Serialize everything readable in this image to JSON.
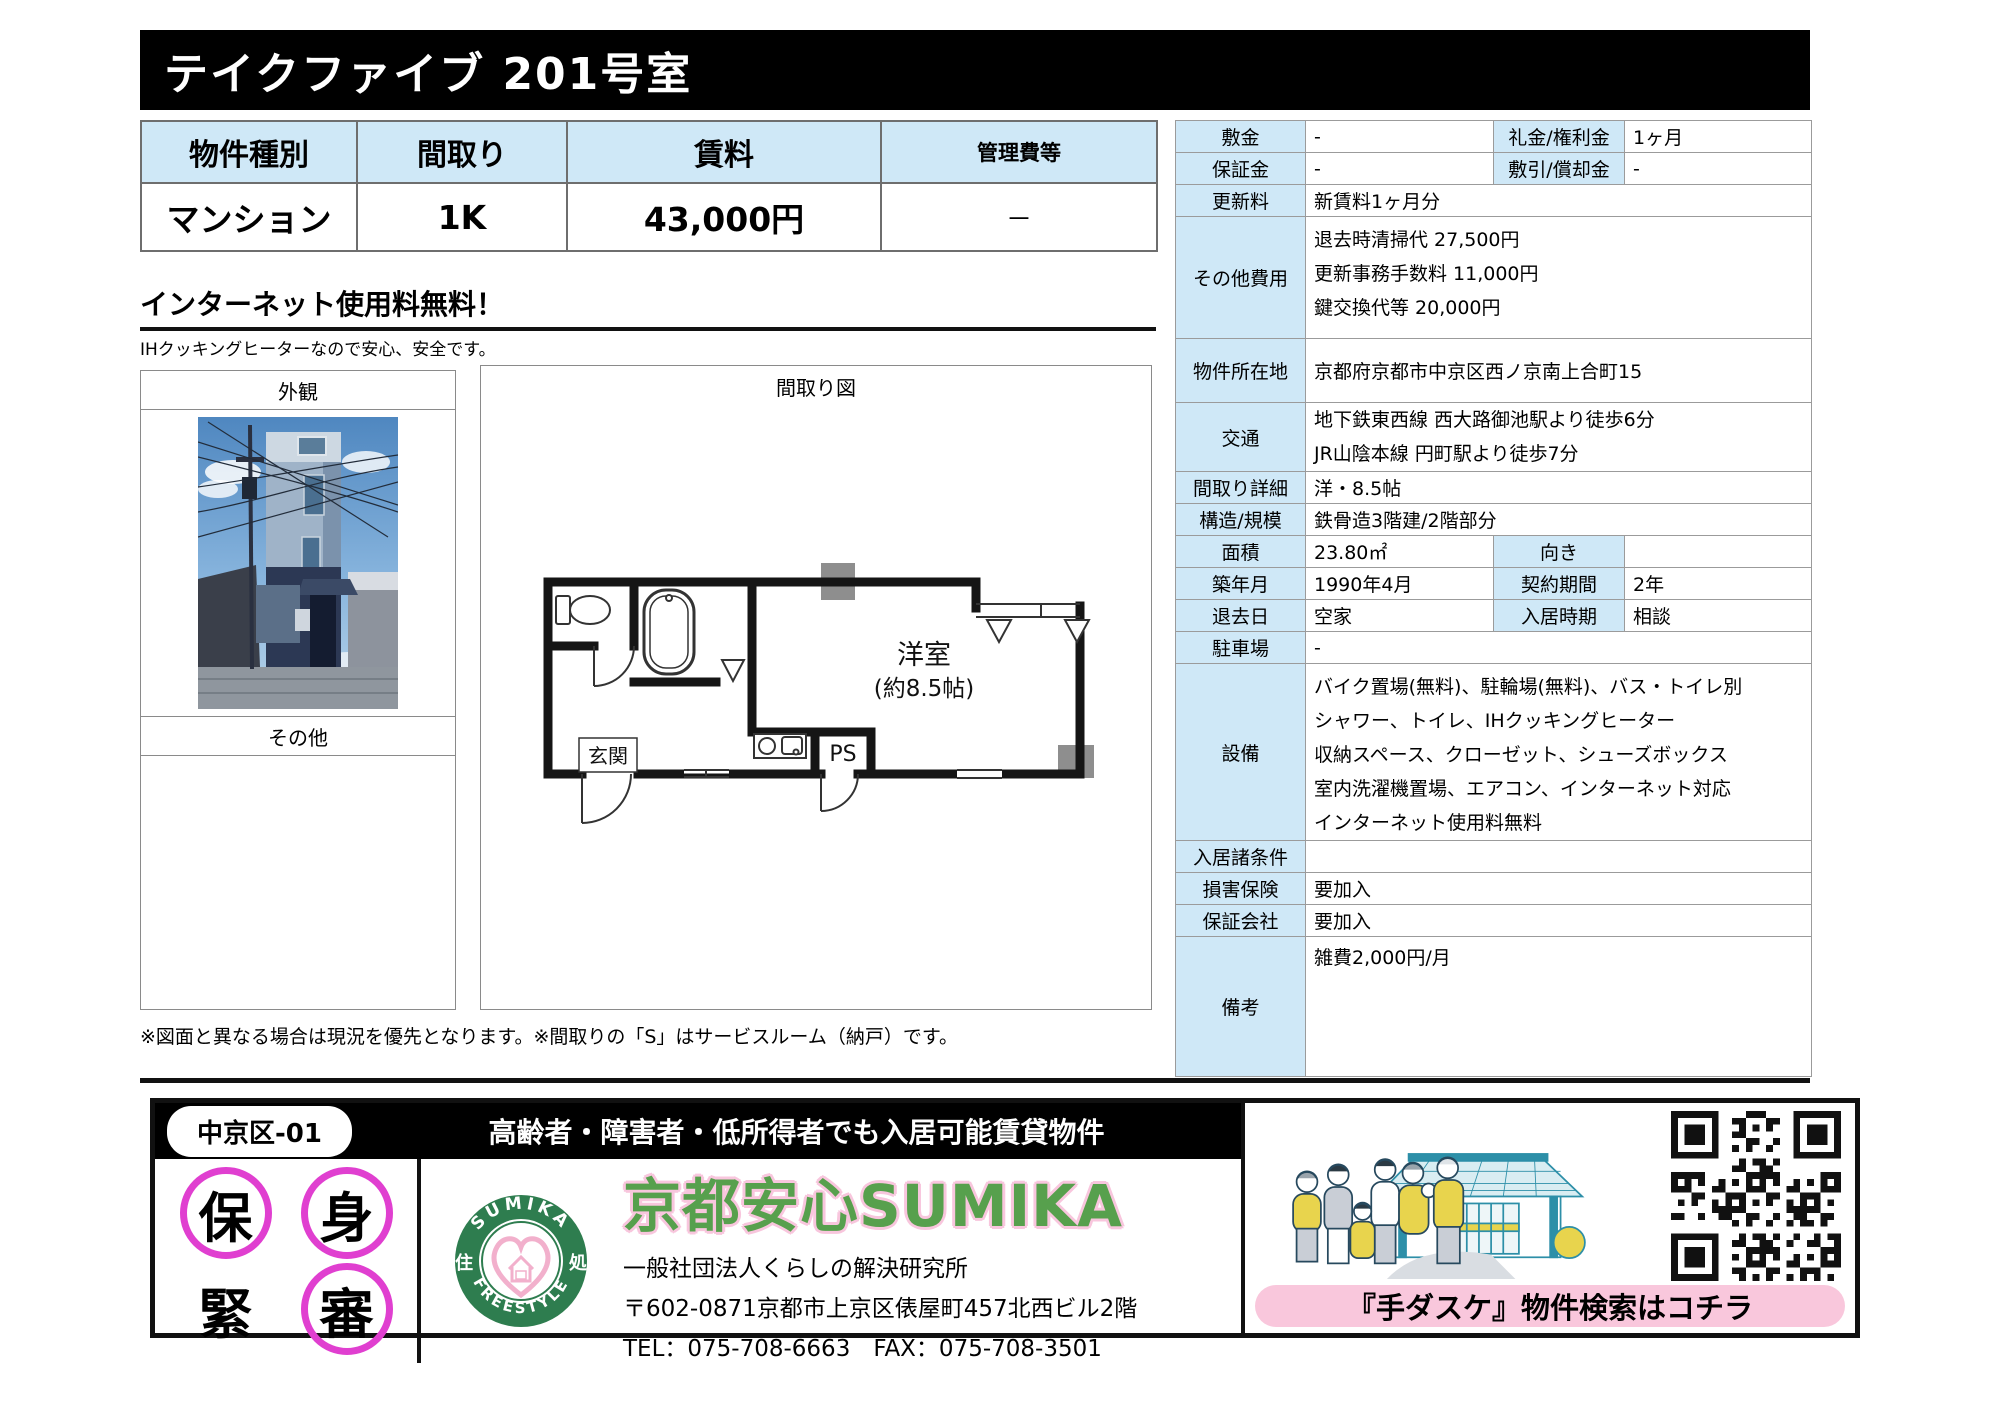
{
  "title": "テイクファイブ 201号室",
  "summary_table": {
    "headers": [
      "物件種別",
      "間取り",
      "賃料",
      "管理費等"
    ],
    "values": [
      "マンション",
      "1K",
      "43,000円",
      "－"
    ]
  },
  "catch_copy": {
    "headline": "インターネット使用料無料！",
    "subtext": "IHクッキングヒーターなので安心、安全です。"
  },
  "photo_panel": {
    "exterior_label": "外観",
    "other_label": "その他"
  },
  "floorplan_panel": {
    "label": "間取り図",
    "room_label": "洋室",
    "room_size": "(約8.5帖)",
    "entrance_label": "玄関",
    "ps_label": "PS"
  },
  "note": "※図面と異なる場合は現況を優先となります。※間取りの「S」はサービスルーム（納戸）です。",
  "details": {
    "rows": [
      {
        "label": "敷金",
        "value": "-",
        "label2": "礼金/権利金",
        "value2": "1ヶ月"
      },
      {
        "label": "保証金",
        "value": "-",
        "label2": "敷引/償却金",
        "value2": "-"
      },
      {
        "label": "更新料",
        "value": "新賃料1ヶ月分"
      },
      {
        "label": "その他費用",
        "lines": [
          "退去時清掃代 27,500円",
          "更新事務手数料 11,000円",
          "鍵交換代等 20,000円"
        ]
      },
      {
        "label": "物件所在地",
        "value": "京都府京都市中京区西ノ京南上合町15"
      },
      {
        "label": "交通",
        "lines": [
          "地下鉄東西線 西大路御池駅より徒歩6分",
          "JR山陰本線 円町駅より徒歩7分"
        ]
      },
      {
        "label": "間取り詳細",
        "value": "洋・8.5帖"
      },
      {
        "label": "構造/規模",
        "value": "鉄骨造3階建/2階部分"
      },
      {
        "label": "面積",
        "value": "23.80㎡",
        "label2": "向き",
        "value2": ""
      },
      {
        "label": "築年月",
        "value": "1990年4月",
        "label2": "契約期間",
        "value2": "2年"
      },
      {
        "label": "退去日",
        "value": "空家",
        "label2": "入居時期",
        "value2": "相談"
      },
      {
        "label": "駐車場",
        "value": "-"
      },
      {
        "label": "設備",
        "lines": [
          "バイク置場(無料)、駐輪場(無料)、バス・トイレ別",
          "シャワー、トイレ、IHクッキングヒーター",
          "収納スペース、クローゼット、シューズボックス",
          "室内洗濯機置場、エアコン、インターネット対応",
          "インターネット使用料無料"
        ]
      },
      {
        "label": "入居諸条件",
        "value": ""
      },
      {
        "label": "損害保険",
        "value": "要加入"
      },
      {
        "label": "保証会社",
        "value": "要加入"
      },
      {
        "label": "備考",
        "value": "雑費2,000円/月"
      }
    ]
  },
  "footer": {
    "area_tag": "中京区-01",
    "banner": "高齢者・障害者・低所得者でも入居可能賃貸物件",
    "stamps": [
      "保",
      "身",
      "緊",
      "審"
    ],
    "logo": {
      "arc_top": "SUMIKA",
      "arc_bottom": "FREESTYLE",
      "left_char": "住",
      "right_char": "処"
    },
    "company_title": "京都安心SUMIKA",
    "company_name": "一般社団法人くらしの解決研究所",
    "address": "〒602-0871京都市上京区俵屋町457北西ビル2階",
    "tel_fax": "TEL：075-708-6663　FAX：075-708-3501",
    "search_banner": "『手ダスケ』物件検索はコチラ"
  },
  "colors": {
    "header_blue": "#cfe8f7",
    "stamp_magenta": "#e03fd0",
    "logo_green": "#2e7d4f",
    "title_green": "#57a04d",
    "pill_pink": "#f9c7dc"
  }
}
